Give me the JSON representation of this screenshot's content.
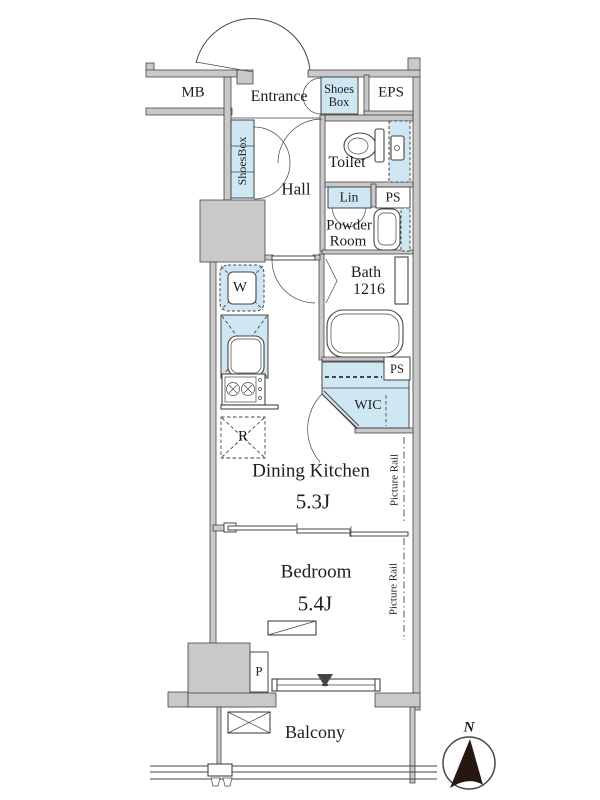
{
  "title": "Apartment floor plan",
  "colors": {
    "wall_gray": "#c9c9c9",
    "line": "#454545",
    "fixture_blue": "#cfe7f3",
    "text": "#1d1d1d",
    "compass": "#261810"
  },
  "plan": {
    "upper": {
      "mb": "MB",
      "entrance": "Entrance",
      "shoes_box": [
        "Shoes",
        "Box"
      ],
      "eps": "EPS",
      "shoes_box_column": "ShoesBox"
    },
    "sanitary": {
      "toilet": "Toilet",
      "hall": "Hall",
      "linen": "Lin",
      "ps_upper": "PS",
      "powder_room": [
        "Powder",
        "Room"
      ],
      "bath": [
        "Bath",
        "1216"
      ],
      "washer": "W",
      "ps_middle": "PS",
      "wic": "WIC"
    },
    "kitchen": {
      "refrigerator": "R"
    },
    "living": {
      "dining_kitchen": "Dining Kitchen",
      "dining_kitchen_size": "5.3J",
      "picture_rail_dk": "Picture Rail",
      "bedroom": "Bedroom",
      "bedroom_size": "5.4J",
      "picture_rail_bedroom": "Picture Rail",
      "pipe": "P"
    },
    "outdoor": {
      "balcony": "Balcony",
      "north": "N"
    }
  }
}
